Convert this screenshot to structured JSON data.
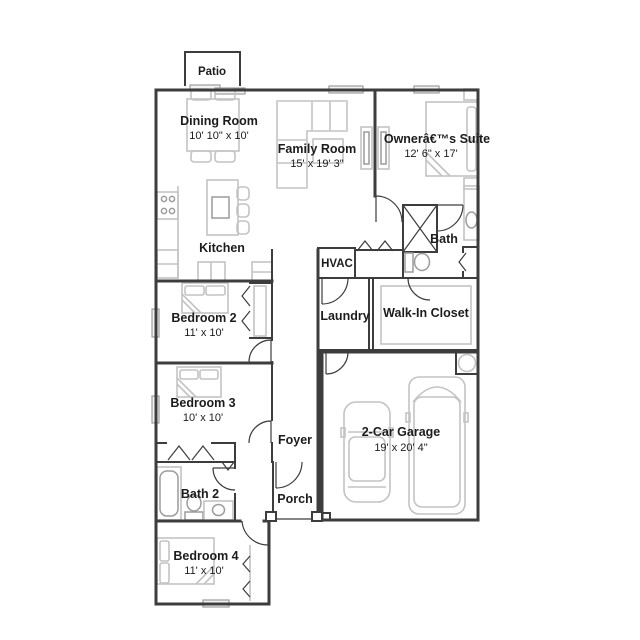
{
  "floor_plan": {
    "rooms": {
      "patio": {
        "name": "Patio"
      },
      "dining": {
        "name": "Dining Room",
        "dims": "10' 10\" x 10'"
      },
      "family": {
        "name": "Family Room",
        "dims": "15' x 19' 3\""
      },
      "owners": {
        "name": "Ownerâ€™s Suite",
        "dims": "12' 6\" x 17'"
      },
      "kitchen": {
        "name": "Kitchen"
      },
      "bath": {
        "name": "Bath"
      },
      "hvac": {
        "name": "HVAC"
      },
      "laundry": {
        "name": "Laundry"
      },
      "walkin": {
        "name": "Walk-In Closet"
      },
      "bed2": {
        "name": "Bedroom 2",
        "dims": "11' x 10'"
      },
      "bed3": {
        "name": "Bedroom 3",
        "dims": "10' x 10'"
      },
      "foyer": {
        "name": "Foyer"
      },
      "porch": {
        "name": "Porch"
      },
      "bath2": {
        "name": "Bath 2"
      },
      "garage": {
        "name": "2-Car Garage",
        "dims": "19' x 20' 4\""
      },
      "bed4": {
        "name": "Bedroom 4",
        "dims": "11' x 10'"
      }
    },
    "colors": {
      "wall": "#3d3d3d",
      "furniture": "#c3c3c3",
      "fixture": "#9c9c9c",
      "label": "#1c1c1c",
      "background": "#ffffff"
    }
  }
}
